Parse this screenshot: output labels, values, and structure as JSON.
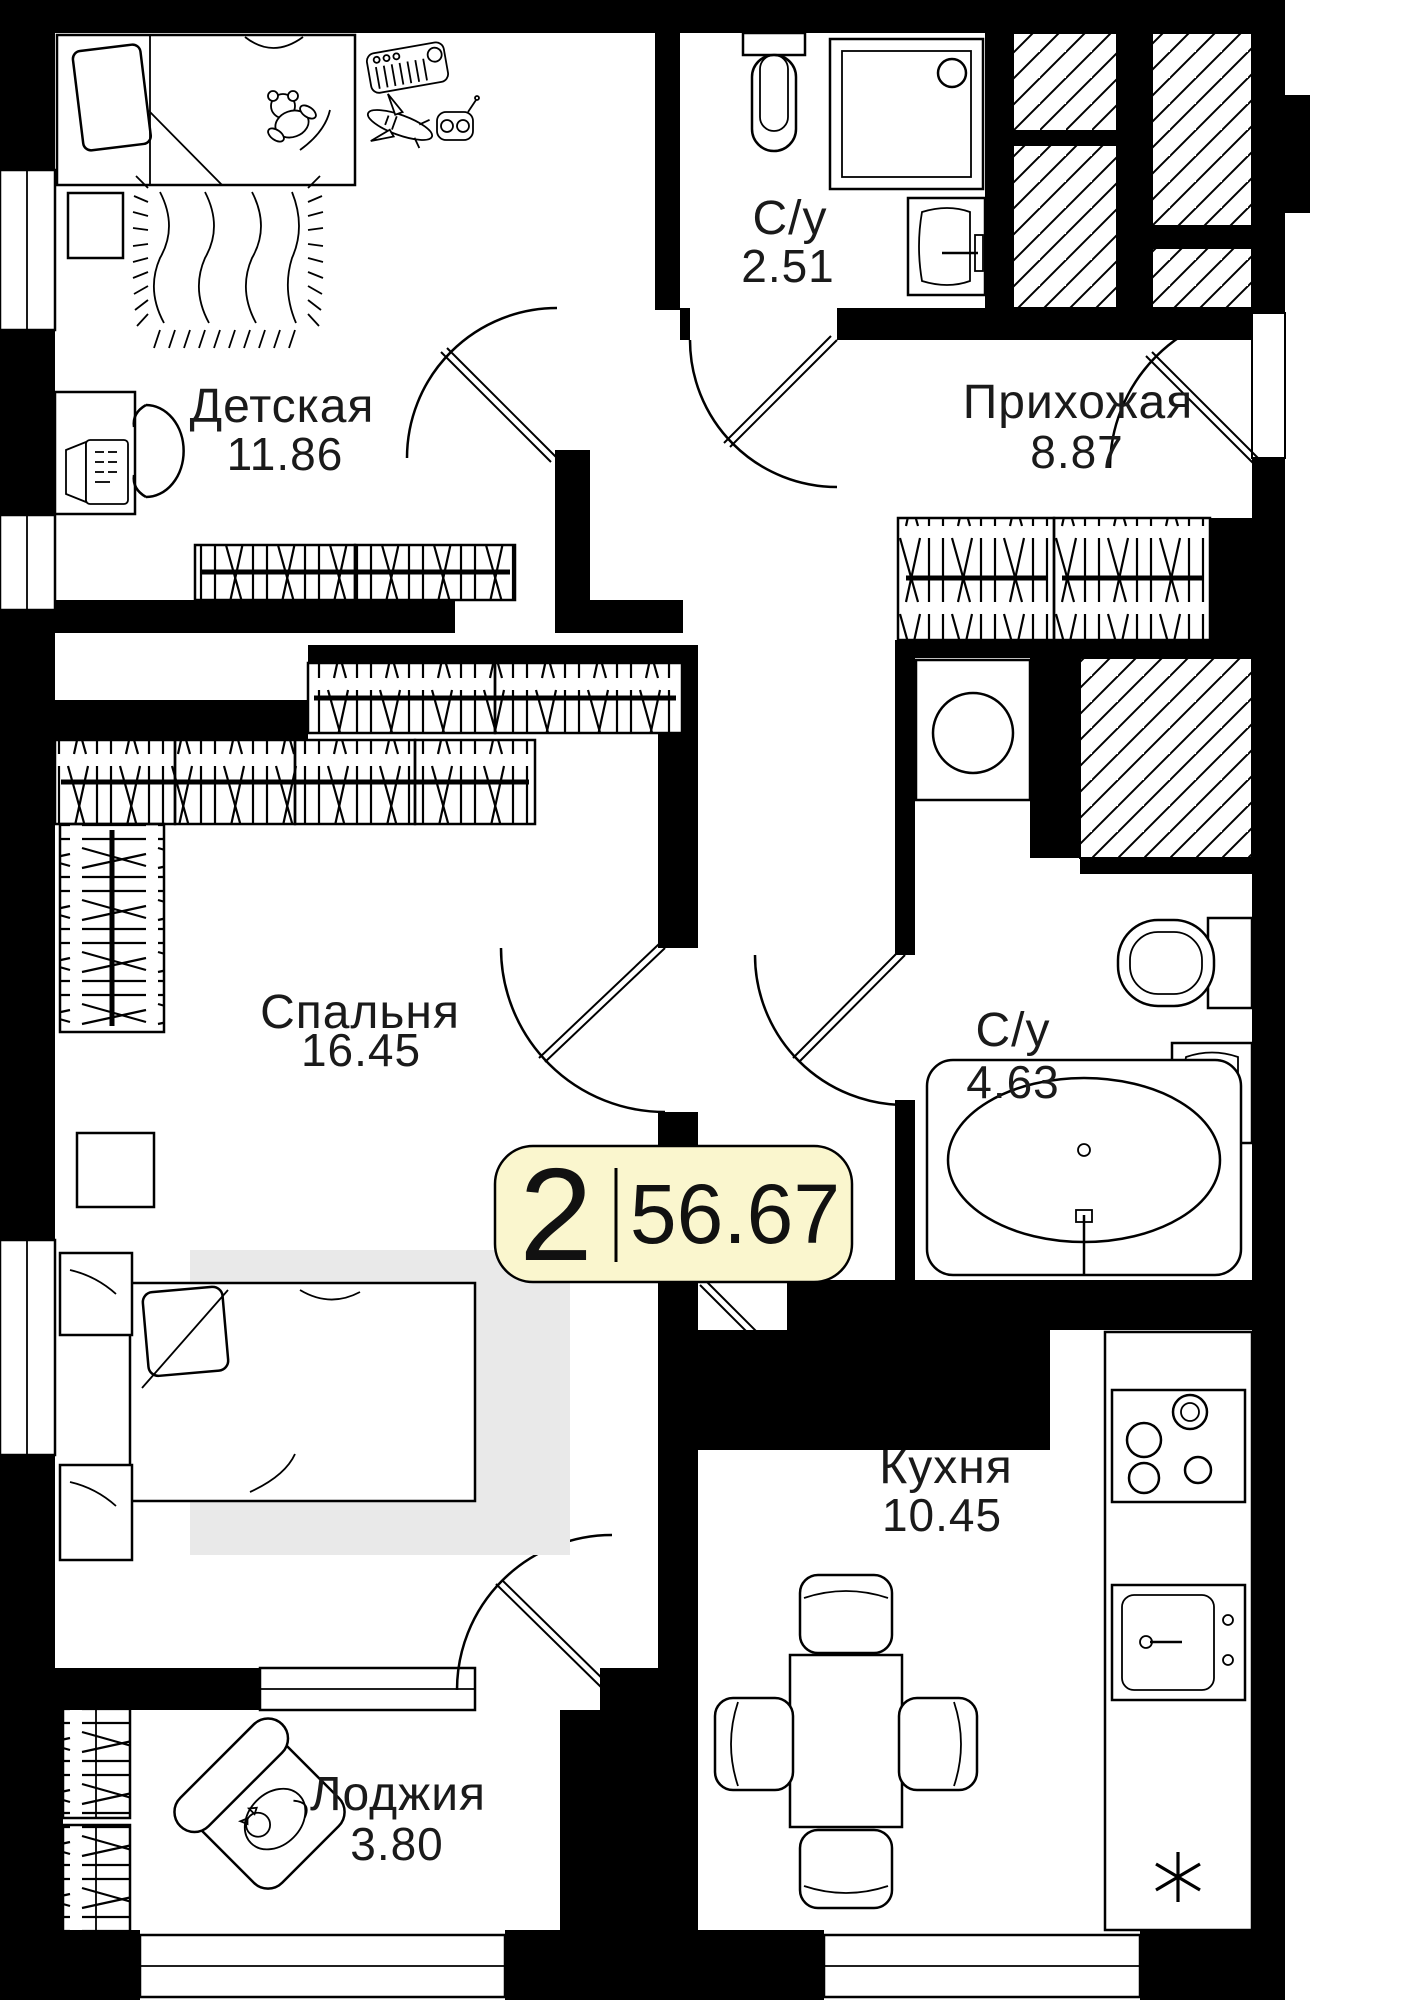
{
  "floorplan": {
    "badge": {
      "rooms_count": "2",
      "total_area": "56.67"
    },
    "rooms": [
      {
        "id": "detskaya",
        "name": "Детская",
        "area": "11.86"
      },
      {
        "id": "su-small",
        "name": "С/у",
        "area": "2.51"
      },
      {
        "id": "prihozhaya",
        "name": "Прихожая",
        "area": "8.87"
      },
      {
        "id": "spalnya",
        "name": "Спальня",
        "area": "16.45"
      },
      {
        "id": "su-big",
        "name": "С/у",
        "area": "4.63"
      },
      {
        "id": "kuhnya",
        "name": "Кухня",
        "area": "10.45"
      },
      {
        "id": "lodzhiya",
        "name": "Лоджия",
        "area": "3.80"
      }
    ],
    "symbols": {
      "asterisk_marker": "✳"
    },
    "colors": {
      "wall": "#000000",
      "background": "#ffffff",
      "badge_bg": "#FAF6CE",
      "badge_border": "#000000",
      "bed_rug": "#E9E9E9"
    }
  }
}
